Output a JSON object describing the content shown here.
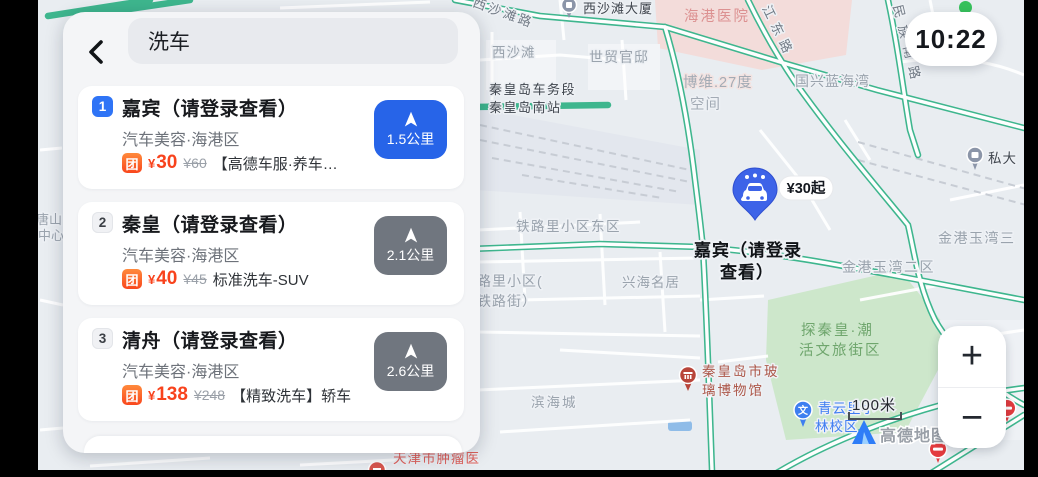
{
  "status_bar": {
    "time": "10:22"
  },
  "search": {
    "query": "洗车"
  },
  "results": [
    {
      "rank": "1",
      "title": "嘉宾（请登录查看）",
      "subtitle": "汽车美容·海港区",
      "deal_badge": "团",
      "price_symbol": "¥",
      "price": "30",
      "original_price": "¥60",
      "deal_desc": "【高德车服·养车…",
      "distance": "1.5公里",
      "highlighted": true
    },
    {
      "rank": "2",
      "title": "秦皇（请登录查看）",
      "subtitle": "汽车美容·海港区",
      "deal_badge": "团",
      "price_symbol": "¥",
      "price": "40",
      "original_price": "¥45",
      "deal_desc": "标准洗车-SUV",
      "distance": "2.1公里",
      "highlighted": false
    },
    {
      "rank": "3",
      "title": "清舟（请登录查看）",
      "subtitle": "汽车美容·海港区",
      "deal_badge": "团",
      "price_symbol": "¥",
      "price": "138",
      "original_price": "¥248",
      "deal_desc": "【精致洗车】轿车",
      "distance": "2.6公里",
      "highlighted": false
    }
  ],
  "map": {
    "selected": {
      "price_bubble": "¥30起",
      "label_line1": "嘉宾（请登录",
      "label_line2": "查看）"
    },
    "labels": {
      "west_beach_road": "西沙滩路",
      "west_beach_tower": "西沙滩大厦",
      "harbor_hospital": "海港医院",
      "west_beach": "西沙滩",
      "shimao_mansion": "世贸官邸",
      "jiangdong_road": "江东路",
      "bowei_line1": "博维.27度",
      "bowei_line2": "空间",
      "guoxing_blue_bay": "国兴蓝海湾",
      "qhd_depot": "秦皇岛车务段",
      "qhd_south_station": "秦皇岛南站",
      "minzu_south_road": "民族南路",
      "sida": "私大",
      "tielu_east_block": "铁路里小区东区",
      "tielu_block_line1": "路里小区(",
      "tielu_block_line2": "铁路街）",
      "xinghai_mingju": "兴海名居",
      "jingang_bay3": "金港玉湾三",
      "jingang_bay2": "金港玉湾二区",
      "tanqinhuang_line1": "探秦皇·潮",
      "tanqinhuang_line2": "活文旅街区",
      "museum_line1": "秦皇岛市玻",
      "museum_line2": "璃博物馆",
      "binhaicheng": "滨海城",
      "tianjin_tumor_hospital": "天津市肿瘤医",
      "qingyun_line1": "青云里小",
      "qingyun_line2": "林校区",
      "tangshan_partial_line1": "唐山",
      "tangshan_partial_line2": "中心"
    },
    "scale_text": "100米",
    "watermark": "高德地图",
    "controls": {
      "zoom_in": "+",
      "zoom_out": "−"
    }
  },
  "colors": {
    "accent_blue": "#2764e8",
    "price_red": "#f8431d",
    "deal_orange": "#f9471d",
    "road_green": "#3eb68e",
    "distance_gray": "#70767f",
    "park_green": "#cde7cb",
    "hospital_pink": "#f3dcda",
    "status_dot_green": "#36c05b"
  }
}
